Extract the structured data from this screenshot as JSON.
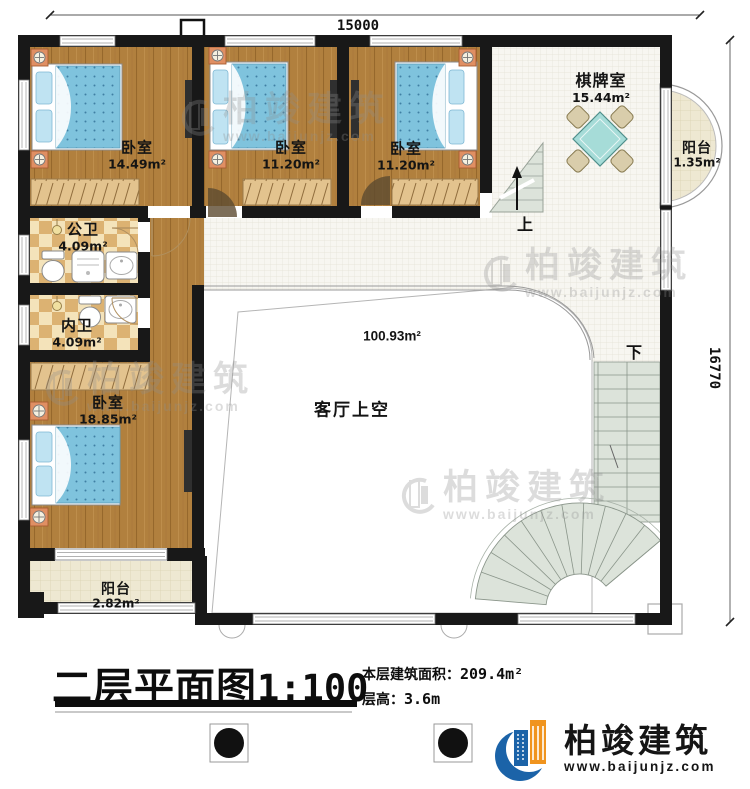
{
  "plan": {
    "title": "二层平面图",
    "scale": "1:100",
    "stats": {
      "area_label": "本层建筑面积：",
      "area_value": "209.4m²",
      "height_label": "层高：",
      "height_value": "3.6m"
    },
    "dimensions": {
      "top": "15000",
      "right": "16770"
    },
    "rooms": {
      "bedroom1": {
        "name": "卧室",
        "area": "14.49m²"
      },
      "bedroom2": {
        "name": "卧室",
        "area": "11.20m²"
      },
      "bedroom3": {
        "name": "卧室",
        "area": "11.20m²"
      },
      "chess_room": {
        "name": "棋牌室",
        "area": "15.44m²"
      },
      "balcony_right": {
        "name": "阳台",
        "area": "1.35m²"
      },
      "public_bath": {
        "name": "公卫",
        "area": "4.09m²"
      },
      "inner_bath": {
        "name": "内卫",
        "area": "4.09m²"
      },
      "bedroom4": {
        "name": "卧室",
        "area": "18.85m²"
      },
      "living_void": {
        "name": "客厅上空",
        "area": "100.93m²"
      },
      "balcony_bottom": {
        "name": "阳台",
        "area": "2.82m²"
      }
    },
    "stairs": {
      "up_label": "上",
      "down_label": "下"
    }
  },
  "brand": {
    "name": "柏竣建筑",
    "url": "www.baijunjz.com"
  },
  "watermark": {
    "name": "柏竣建筑",
    "url": "www.baijunjz.com"
  },
  "colors": {
    "wall": "#181818",
    "wood": "#b1803e",
    "bed": "#7fc3dd",
    "tile_light": "#f4e3ba",
    "tile_dark": "#dcb272",
    "corridor": "#f7f6f1",
    "stair": "#dce3da",
    "table": "#a6dcd8",
    "chair": "#d9cdab",
    "balcony": "#eee8d2",
    "logo_blue": "#1b63a8",
    "logo_orange": "#f0941e"
  }
}
